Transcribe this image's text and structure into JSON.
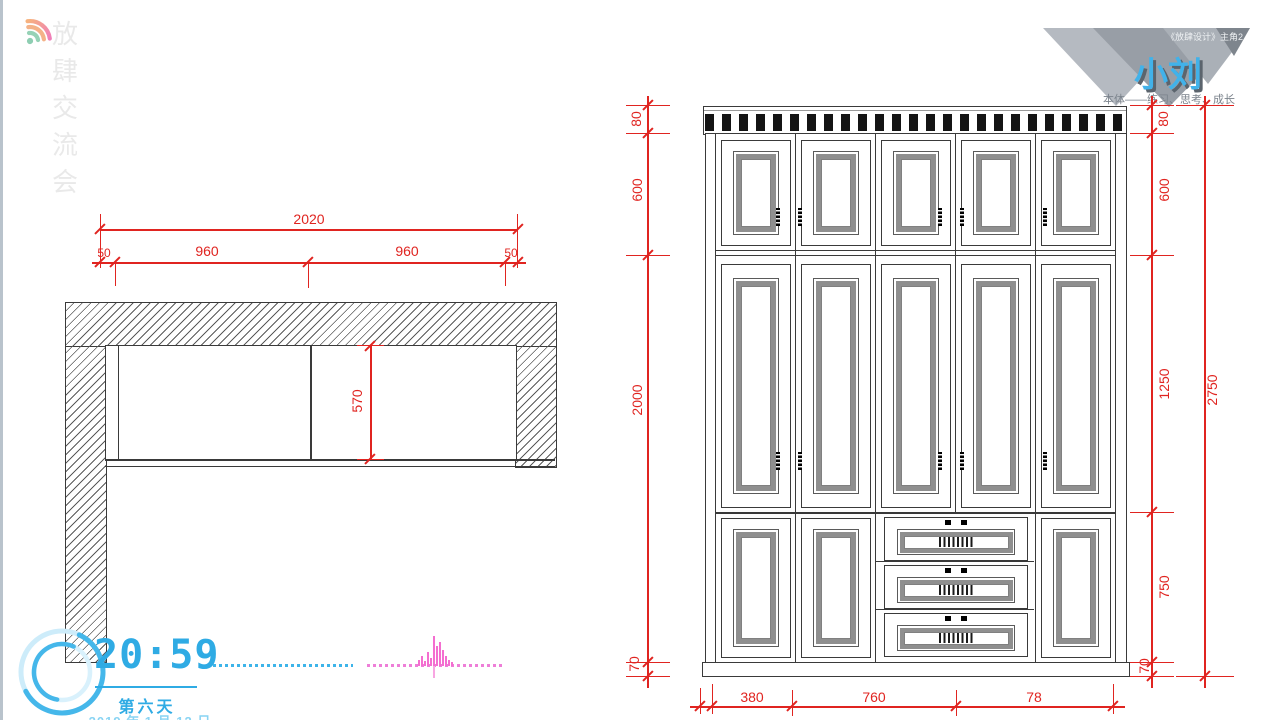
{
  "watermark": {
    "brand_text": "放肆交流会",
    "icon": "wifi-icon"
  },
  "badge": {
    "series_label": "《放肆设计》主角2",
    "presenter_name": "小刘",
    "slogan": "本体——练习、思考、成长",
    "name_color": "#41b2ea"
  },
  "clock": {
    "time": "20:59",
    "day_label": "第六天",
    "date_label": "2019 年 1 月 12 日",
    "accent_color": "#2fabe4",
    "icon": "progress-ring-icon"
  },
  "plan": {
    "title": "wardrobe-plan-view",
    "dims": {
      "total_width": "2020",
      "left_margin": "50",
      "left_section": "960",
      "right_section": "960",
      "right_margin": "50",
      "depth": "570"
    }
  },
  "elevation": {
    "title": "wardrobe-elevation-view",
    "dims": {
      "left": {
        "crown": "80",
        "upper": "600",
        "body": "2000",
        "base": "70"
      },
      "right": {
        "crown": "80",
        "upper": "600",
        "middle": "1250",
        "lower": "750",
        "base": "70",
        "total": "2750"
      },
      "bottom": {
        "seg1": "380",
        "seg2": "760",
        "seg3": "78"
      }
    },
    "dimension_color": "#e02420"
  }
}
